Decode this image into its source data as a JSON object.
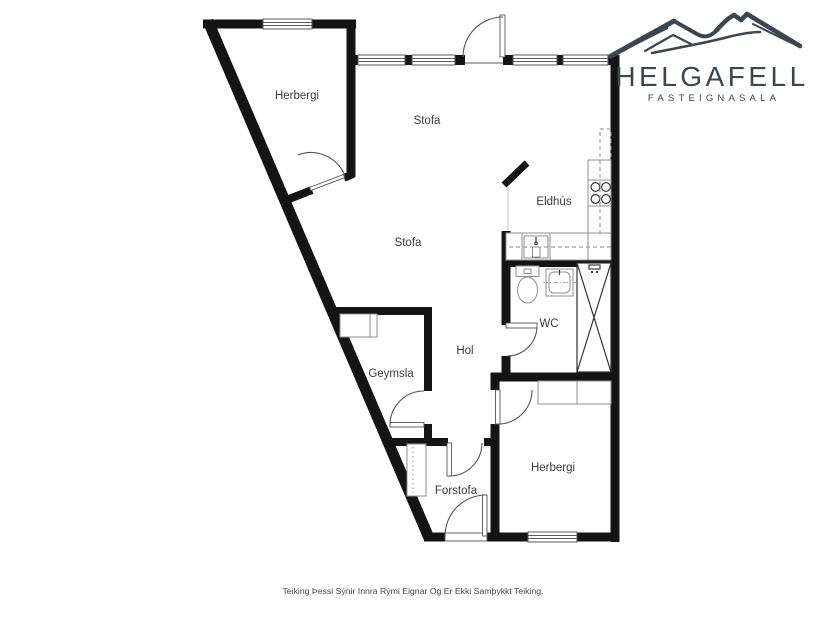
{
  "logo": {
    "name": "HELGAFELL",
    "tagline": "FASTEIGNASALA",
    "color": "#3e454c"
  },
  "floorplan": {
    "wall_color": "#141414",
    "rooms": {
      "herbergi1": {
        "label": "Herbergi"
      },
      "stofa1": {
        "label": "Stofa"
      },
      "eldhus": {
        "label": "Eldhús"
      },
      "stofa2": {
        "label": "Stofa"
      },
      "wc": {
        "label": "WC"
      },
      "hol": {
        "label": "Hol"
      },
      "geymsla": {
        "label": "Geymsla"
      },
      "herbergi2": {
        "label": "Herbergi"
      },
      "forstofa": {
        "label": "Forstofa"
      }
    },
    "fixtures": [
      "kitchen-counter",
      "stove",
      "kitchen-sink",
      "upper-cabinets-dashed",
      "toilet",
      "washbasin",
      "shower",
      "storage-shelf",
      "hall-closet",
      "bedroom-closet"
    ]
  },
  "disclaimer": {
    "text": "Teiking Þessi Sýnir Innra Rými Eignar Og Er Ekki Samþykkt Teiking,"
  }
}
